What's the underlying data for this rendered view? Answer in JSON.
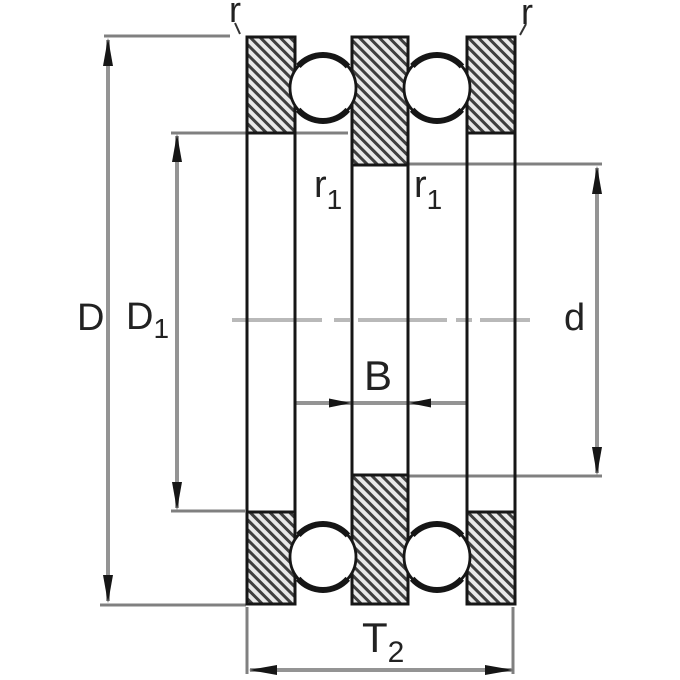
{
  "diagram": {
    "type": "bearing-cross-section",
    "description_visible_text_only": "dimension annotations of a double-direction thrust ball bearing drawing"
  },
  "dimensions": {
    "outside_diameter": {
      "label": "D"
    },
    "shoulder_diameter": {
      "label": "D",
      "subscript": "1"
    },
    "bore_diameter": {
      "label": "d"
    },
    "shaft_washer_width": {
      "label": "B"
    },
    "total_height": {
      "label": "T",
      "subscript": "2"
    },
    "chamfer_top_left": {
      "label": "r"
    },
    "chamfer_top_right": {
      "label": "r"
    },
    "chamfer_inner_left": {
      "label": "r",
      "subscript": "1"
    },
    "chamfer_inner_right": {
      "label": "r",
      "subscript": "1"
    }
  },
  "colors": {
    "background": "#ffffff",
    "outline_black": "#161616",
    "dimension_line_gray": "#949494",
    "extension_line_gray": "#808080",
    "centerline_gray": "#b9b9b9",
    "hatch_dark": "#3f3f3f",
    "hatch_light": "#e9e9e9",
    "label_color": "#222222"
  }
}
